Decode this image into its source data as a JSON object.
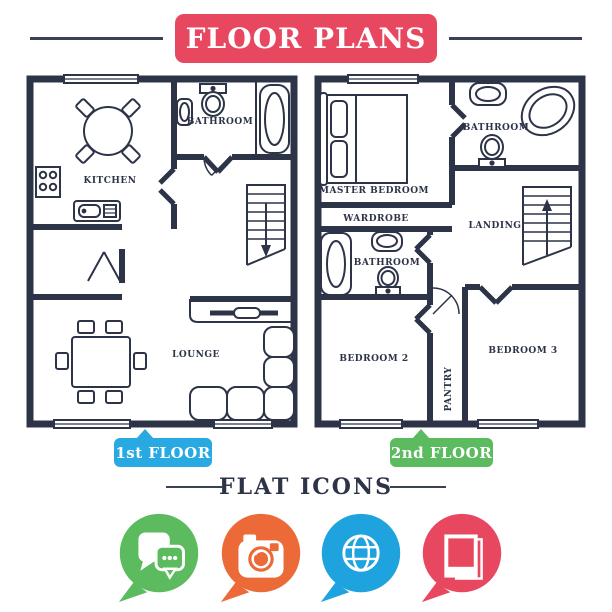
{
  "title": {
    "text": "FLOOR PLANS",
    "bg_color": "#E8485F",
    "text_color": "#FFFFFF"
  },
  "colors": {
    "navy_lines": "#2D3448",
    "red": "#E8485F",
    "blue": "#29A9E1",
    "green": "#5BBB5E",
    "orange": "#EC6A38",
    "globe_blue": "#1FA3DF",
    "background": "#FFFFFF"
  },
  "plans": {
    "first": {
      "label": "1st FLOOR",
      "badge_color": "#29A9E1",
      "rooms": {
        "kitchen": "KITCHEN",
        "bathroom": "BATHROOM",
        "lounge": "LOUNGE"
      }
    },
    "second": {
      "label": "2nd FLOOR",
      "badge_color": "#5BBB5E",
      "rooms": {
        "master_bedroom": "MASTER BEDROOM",
        "bathroom_ensuite": "BATHROOM",
        "wardrobe": "WARDROBE",
        "landing": "LANDING",
        "bathroom": "BATHROOM",
        "bedroom2": "BEDROOM 2",
        "pantry": "PANTRY",
        "bedroom3": "BEDROOM 3"
      }
    }
  },
  "icons_section": {
    "heading": "FLAT ICONS",
    "icons": [
      {
        "name": "chat-icon",
        "color": "#5BBB5E"
      },
      {
        "name": "camera-icon",
        "color": "#EC6A38"
      },
      {
        "name": "globe-icon",
        "color": "#1FA3DF"
      },
      {
        "name": "photo-frames-icon",
        "color": "#E8485F"
      }
    ]
  }
}
